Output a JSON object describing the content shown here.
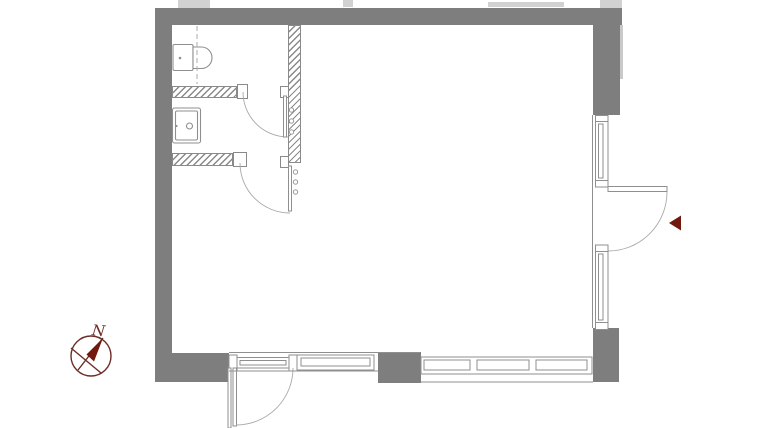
{
  "title": "apartment-floor-plan",
  "compass": {
    "label": "N",
    "icon": "compass-north-icon"
  },
  "colors": {
    "wall_gray": "#7e7e7e",
    "line_gray": "#8f8f8f",
    "hatch_gray": "#8a8a8a",
    "accent_maroon": "#71190f",
    "compass_maroon": "#6d2d27",
    "faint_gray": "#d1d1d1"
  },
  "elements": {
    "fixtures": [
      {
        "name": "toilet"
      },
      {
        "name": "sink"
      }
    ],
    "doors": [
      {
        "name": "wc-door"
      },
      {
        "name": "bathroom-door"
      },
      {
        "name": "entry-door"
      },
      {
        "name": "balcony-door"
      }
    ],
    "windows": [
      {
        "name": "right-window-upper"
      },
      {
        "name": "right-window-lower"
      },
      {
        "name": "bottom-window-left"
      },
      {
        "name": "bottom-window-right"
      }
    ],
    "markers": [
      {
        "name": "entrance-arrow"
      },
      {
        "name": "north-compass"
      }
    ]
  }
}
